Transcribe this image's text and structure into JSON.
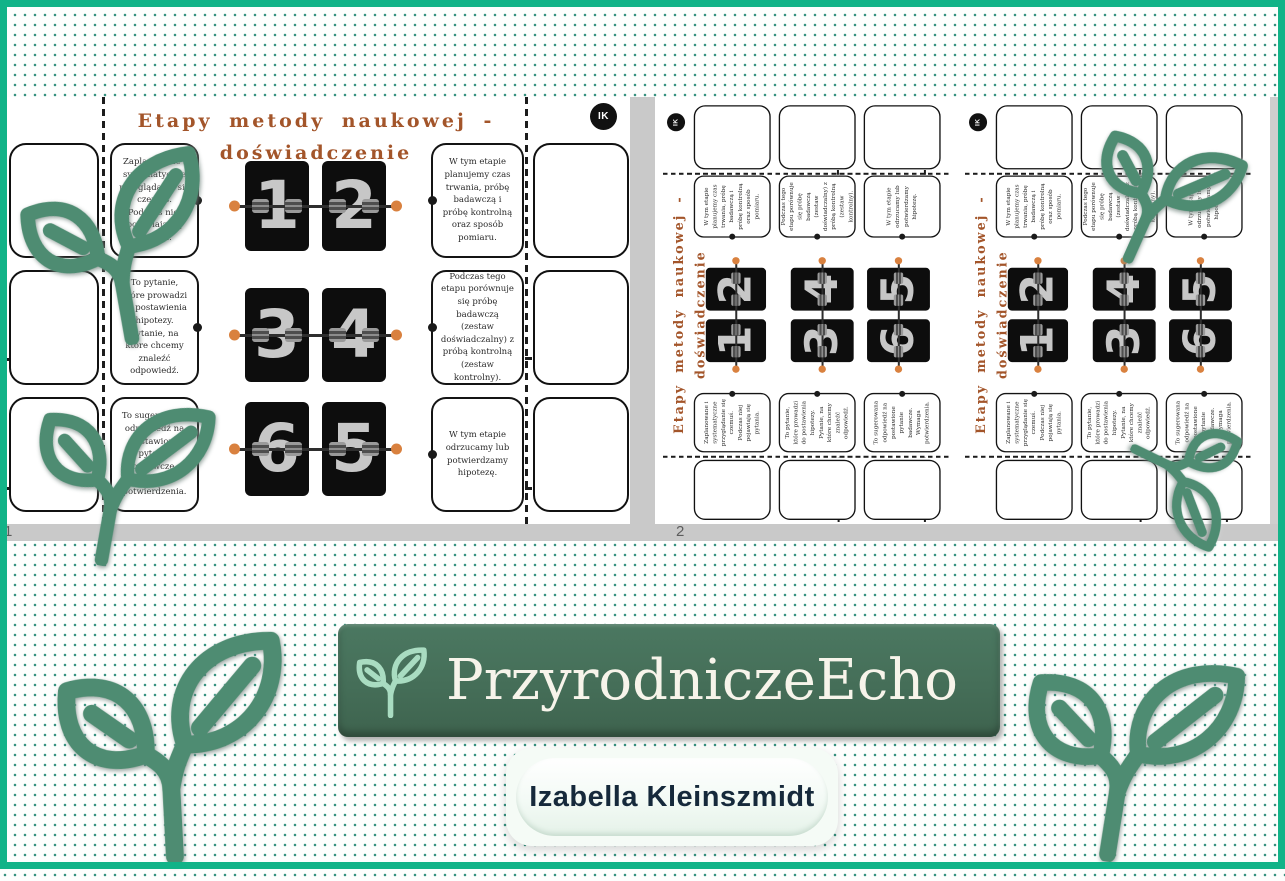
{
  "colors": {
    "frame_green": "#12b388",
    "dot_teal": "#35907e",
    "banner_green": "#456e58",
    "banner_leaf_mint": "#a9dcc1",
    "leaf_green": "#4e8c72",
    "title_brown": "#a3552a",
    "flip_rod_orange": "#d9813f",
    "viewer_gray": "#c9c9c9"
  },
  "viewer": {
    "page1_number": "1",
    "page2_number": "2"
  },
  "worksheet": {
    "title_line1": "Etapy metody naukowej -",
    "title_line2": "doświadczenie",
    "badge_initials": "IK",
    "left_boxes": [
      "Zaplanowane i systematyczne przyglądanie się czemuś. Podczas niej pojawiają się pytania.",
      "To pytanie, które prowadzi do postawienia hipotezy. Pytanie, na które chcemy znaleźć odpowiedź.",
      "To sugerowana odpowiedź na postawione pytanie badawcze. Wymaga potwierdzenia."
    ],
    "right_boxes": [
      "W tym etapie planujemy czas trwania, próbę badawczą i próbę kontrolną oraz sposób pomiaru.",
      "Podczas tego etapu porównuje się próbę badawczą (zestaw doświadczalny)  z próbą kontrolną (zestaw kontrolny).",
      "W tym etapie odrzucamy lub potwierdzamy hipotezę."
    ],
    "flip_rows": [
      [
        "1",
        "2"
      ],
      [
        "3",
        "4"
      ],
      [
        "6",
        "5"
      ]
    ]
  },
  "branding": {
    "name": "PrzyrodniczeEcho",
    "author": "Izabella Kleinszmidt"
  }
}
